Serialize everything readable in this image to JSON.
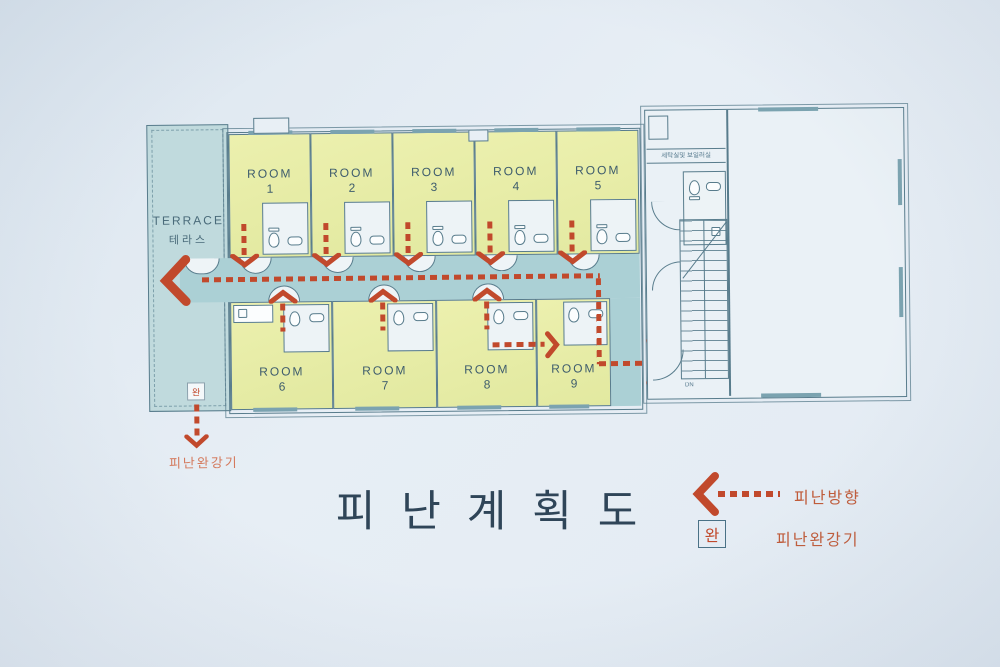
{
  "title": "피 난 계 획 도",
  "plan": {
    "terrace": {
      "en": "TERRACE",
      "ko": "테라스"
    },
    "rooms": [
      {
        "name": "ROOM",
        "number": "1"
      },
      {
        "name": "ROOM",
        "number": "2"
      },
      {
        "name": "ROOM",
        "number": "3"
      },
      {
        "name": "ROOM",
        "number": "4"
      },
      {
        "name": "ROOM",
        "number": "5"
      },
      {
        "name": "ROOM",
        "number": "6"
      },
      {
        "name": "ROOM",
        "number": "7"
      },
      {
        "name": "ROOM",
        "number": "8"
      },
      {
        "name": "ROOM",
        "number": "9"
      }
    ],
    "utility_label": "세탁실및 보일러실",
    "stairs_label": "DN"
  },
  "legend": {
    "direction_label": "피난방향",
    "descender_symbol": "완",
    "descender_label": "피난완강기"
  },
  "device": {
    "symbol": "완",
    "label": "피난완강기"
  },
  "colors": {
    "room_fill": "#e9eda9",
    "corridor_fill": "#abd0d5",
    "wall_line": "#587c8c",
    "evacuation_red": "#c1492c",
    "title_color": "#2f4558"
  }
}
